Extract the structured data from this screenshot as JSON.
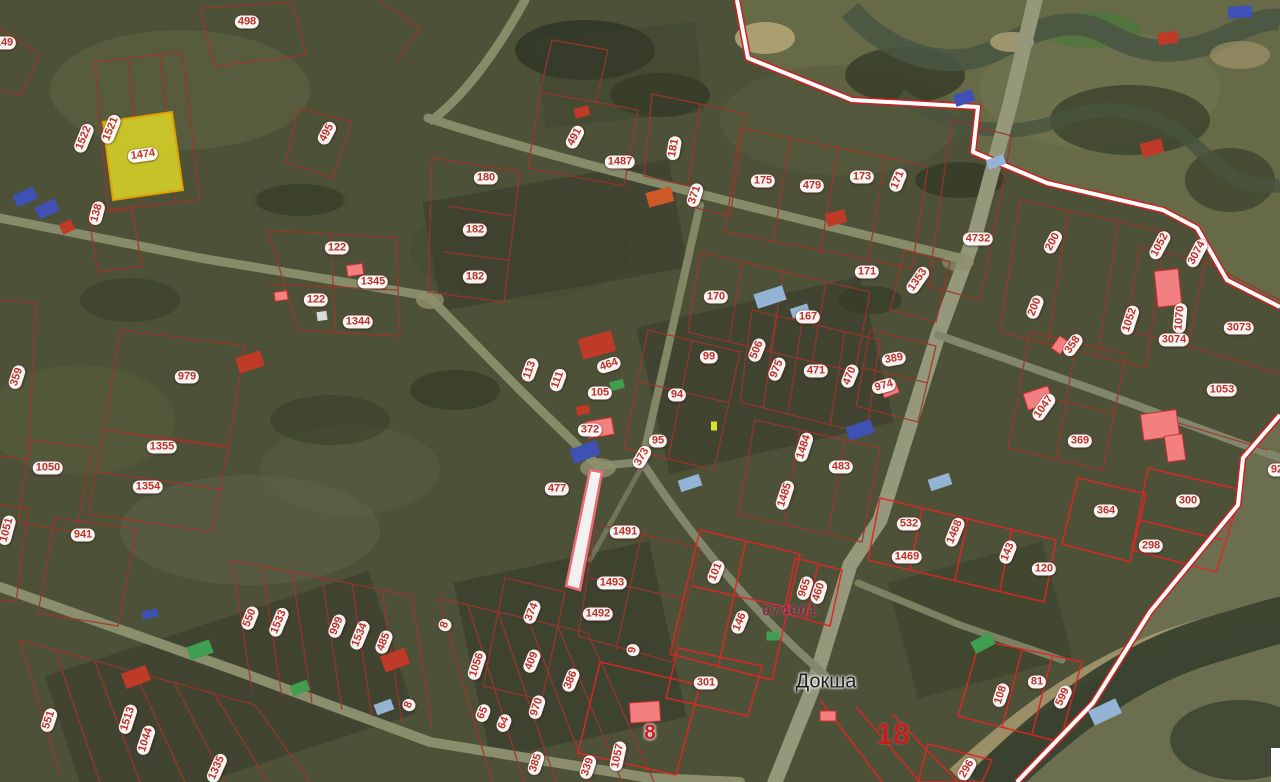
{
  "map": {
    "place_label": "Докша",
    "quarter_number": "074001",
    "district_number": "18",
    "red_parcel_number": "8",
    "selected_parcel_number": "1474",
    "colors": {
      "label_text": "#c03028",
      "label_bubble": "#ffffff",
      "parcel_line": "#9e352b",
      "parcel_line_selected_quarter": "#e02525",
      "settlement_boundary": "#cc2222",
      "selected_parcel_fill": "#d6d327",
      "selected_parcel_stroke": "#e0a000",
      "quarter_text": "#8d2440",
      "place_text": "#1d1d1d",
      "district_text": "#c41f1f",
      "building": {
        "red": "#c03a28",
        "orange": "#cc5a28",
        "pink": "#f28080",
        "blue": "#3f51b5",
        "lightblue": "#93b4d4",
        "green": "#3f9e4f",
        "white": "#dcdcdc",
        "yellow": "#d8e030"
      }
    },
    "parcel_labels": [
      {
        "t": "498",
        "x": 247,
        "y": 22,
        "r": 0
      },
      {
        "t": "149",
        "x": 4,
        "y": 43,
        "r": 0
      },
      {
        "t": "1522",
        "x": 84,
        "y": 138,
        "r": -68
      },
      {
        "t": "1521",
        "x": 111,
        "y": 129,
        "r": -68
      },
      {
        "t": "1474",
        "x": 143,
        "y": 155,
        "r": -8
      },
      {
        "t": "138",
        "x": 97,
        "y": 213,
        "r": -75
      },
      {
        "t": "495",
        "x": 327,
        "y": 133,
        "r": -62
      },
      {
        "t": "122",
        "x": 337,
        "y": 248,
        "r": 0
      },
      {
        "t": "122",
        "x": 316,
        "y": 300,
        "r": 0
      },
      {
        "t": "1345",
        "x": 373,
        "y": 282,
        "r": 0
      },
      {
        "t": "1344",
        "x": 358,
        "y": 322,
        "r": 0
      },
      {
        "t": "180",
        "x": 486,
        "y": 178,
        "r": 0
      },
      {
        "t": "182",
        "x": 475,
        "y": 230,
        "r": 0
      },
      {
        "t": "182",
        "x": 475,
        "y": 277,
        "r": 0
      },
      {
        "t": "491",
        "x": 575,
        "y": 137,
        "r": -62
      },
      {
        "t": "1487",
        "x": 620,
        "y": 162,
        "r": 0
      },
      {
        "t": "181",
        "x": 674,
        "y": 148,
        "r": -80
      },
      {
        "t": "371",
        "x": 695,
        "y": 195,
        "r": -72
      },
      {
        "t": "175",
        "x": 763,
        "y": 181,
        "r": 0
      },
      {
        "t": "479",
        "x": 812,
        "y": 186,
        "r": 0
      },
      {
        "t": "173",
        "x": 862,
        "y": 177,
        "r": 0
      },
      {
        "t": "171",
        "x": 898,
        "y": 180,
        "r": -68
      },
      {
        "t": "4732",
        "x": 978,
        "y": 239,
        "r": 0
      },
      {
        "t": "171",
        "x": 867,
        "y": 272,
        "r": 0
      },
      {
        "t": "1353",
        "x": 918,
        "y": 280,
        "r": -55
      },
      {
        "t": "170",
        "x": 716,
        "y": 297,
        "r": 0
      },
      {
        "t": "167",
        "x": 808,
        "y": 317,
        "r": 0
      },
      {
        "t": "200",
        "x": 1053,
        "y": 242,
        "r": -62
      },
      {
        "t": "1052",
        "x": 1160,
        "y": 245,
        "r": -62
      },
      {
        "t": "3074",
        "x": 1197,
        "y": 253,
        "r": -62
      },
      {
        "t": "200",
        "x": 1035,
        "y": 307,
        "r": -68
      },
      {
        "t": "1052",
        "x": 1130,
        "y": 320,
        "r": -72
      },
      {
        "t": "1070",
        "x": 1180,
        "y": 318,
        "r": -85
      },
      {
        "t": "358",
        "x": 1073,
        "y": 345,
        "r": -55
      },
      {
        "t": "3074",
        "x": 1174,
        "y": 340,
        "r": 0
      },
      {
        "t": "3073",
        "x": 1239,
        "y": 328,
        "r": 0
      },
      {
        "t": "1053",
        "x": 1222,
        "y": 390,
        "r": 0
      },
      {
        "t": "1047",
        "x": 1044,
        "y": 407,
        "r": -55
      },
      {
        "t": "369",
        "x": 1080,
        "y": 441,
        "r": 0
      },
      {
        "t": "113",
        "x": 530,
        "y": 370,
        "r": -70
      },
      {
        "t": "111",
        "x": 558,
        "y": 380,
        "r": -70
      },
      {
        "t": "464",
        "x": 609,
        "y": 365,
        "r": -18
      },
      {
        "t": "105",
        "x": 600,
        "y": 393,
        "r": 0
      },
      {
        "t": "99",
        "x": 709,
        "y": 357,
        "r": 0
      },
      {
        "t": "94",
        "x": 677,
        "y": 395,
        "r": 0
      },
      {
        "t": "372",
        "x": 590,
        "y": 430,
        "r": 0
      },
      {
        "t": "95",
        "x": 658,
        "y": 441,
        "r": 0
      },
      {
        "t": "373",
        "x": 642,
        "y": 457,
        "r": -60
      },
      {
        "t": "506",
        "x": 757,
        "y": 350,
        "r": -68
      },
      {
        "t": "975",
        "x": 777,
        "y": 369,
        "r": -68
      },
      {
        "t": "471",
        "x": 816,
        "y": 371,
        "r": 0
      },
      {
        "t": "470",
        "x": 850,
        "y": 376,
        "r": -68
      },
      {
        "t": "1484",
        "x": 804,
        "y": 447,
        "r": -72
      },
      {
        "t": "483",
        "x": 841,
        "y": 467,
        "r": 0
      },
      {
        "t": "1485",
        "x": 785,
        "y": 495,
        "r": -72
      },
      {
        "t": "389",
        "x": 894,
        "y": 359,
        "r": -10
      },
      {
        "t": "974",
        "x": 884,
        "y": 386,
        "r": -15
      },
      {
        "t": "359",
        "x": 17,
        "y": 377,
        "r": -72
      },
      {
        "t": "979",
        "x": 187,
        "y": 377,
        "r": 0
      },
      {
        "t": "1355",
        "x": 162,
        "y": 447,
        "r": 0
      },
      {
        "t": "1050",
        "x": 48,
        "y": 468,
        "r": 0
      },
      {
        "t": "1354",
        "x": 148,
        "y": 487,
        "r": 0
      },
      {
        "t": "477",
        "x": 557,
        "y": 489,
        "r": 0
      },
      {
        "t": "941",
        "x": 83,
        "y": 535,
        "r": 0
      },
      {
        "t": "1051",
        "x": 7,
        "y": 530,
        "r": -75
      },
      {
        "t": "1491",
        "x": 625,
        "y": 532,
        "r": 0
      },
      {
        "t": "1493",
        "x": 612,
        "y": 583,
        "r": 0
      },
      {
        "t": "1492",
        "x": 598,
        "y": 614,
        "r": 0
      },
      {
        "t": "374",
        "x": 532,
        "y": 612,
        "r": -68
      },
      {
        "t": "9",
        "x": 633,
        "y": 650,
        "r": -80
      },
      {
        "t": "8",
        "x": 445,
        "y": 625,
        "r": -70
      },
      {
        "t": "1056",
        "x": 477,
        "y": 665,
        "r": -72
      },
      {
        "t": "409",
        "x": 532,
        "y": 661,
        "r": -68
      },
      {
        "t": "386",
        "x": 571,
        "y": 680,
        "r": -68
      },
      {
        "t": "970",
        "x": 537,
        "y": 707,
        "r": -72
      },
      {
        "t": "65",
        "x": 483,
        "y": 713,
        "r": -68
      },
      {
        "t": "64",
        "x": 504,
        "y": 723,
        "r": -68
      },
      {
        "t": "8",
        "x": 409,
        "y": 705,
        "r": -70
      },
      {
        "t": "550",
        "x": 250,
        "y": 618,
        "r": -68
      },
      {
        "t": "1533",
        "x": 279,
        "y": 622,
        "r": -68
      },
      {
        "t": "999",
        "x": 337,
        "y": 626,
        "r": -68
      },
      {
        "t": "1534",
        "x": 360,
        "y": 635,
        "r": -68
      },
      {
        "t": "485",
        "x": 384,
        "y": 642,
        "r": -68
      },
      {
        "t": "551",
        "x": 49,
        "y": 720,
        "r": -72
      },
      {
        "t": "1513",
        "x": 128,
        "y": 719,
        "r": -72
      },
      {
        "t": "1044",
        "x": 146,
        "y": 740,
        "r": -72
      },
      {
        "t": "1335",
        "x": 217,
        "y": 768,
        "r": -66
      },
      {
        "t": "385",
        "x": 536,
        "y": 763,
        "r": -72
      },
      {
        "t": "339",
        "x": 588,
        "y": 767,
        "r": -72
      },
      {
        "t": "1057",
        "x": 618,
        "y": 756,
        "r": -78
      },
      {
        "t": "101",
        "x": 716,
        "y": 572,
        "r": -68
      },
      {
        "t": "146",
        "x": 740,
        "y": 622,
        "r": -68
      },
      {
        "t": "965",
        "x": 805,
        "y": 588,
        "r": -72
      },
      {
        "t": "460",
        "x": 819,
        "y": 592,
        "r": -72
      },
      {
        "t": "301",
        "x": 706,
        "y": 683,
        "r": 0
      },
      {
        "t": "532",
        "x": 909,
        "y": 524,
        "r": 0
      },
      {
        "t": "1468",
        "x": 955,
        "y": 532,
        "r": -68
      },
      {
        "t": "1469",
        "x": 907,
        "y": 557,
        "r": 0
      },
      {
        "t": "143",
        "x": 1008,
        "y": 552,
        "r": -68
      },
      {
        "t": "120",
        "x": 1044,
        "y": 569,
        "r": 0
      },
      {
        "t": "364",
        "x": 1106,
        "y": 511,
        "r": 0
      },
      {
        "t": "300",
        "x": 1188,
        "y": 501,
        "r": 0
      },
      {
        "t": "298",
        "x": 1151,
        "y": 546,
        "r": 0
      },
      {
        "t": "81",
        "x": 1037,
        "y": 682,
        "r": 0
      },
      {
        "t": "108",
        "x": 1001,
        "y": 695,
        "r": -72
      },
      {
        "t": "599",
        "x": 1063,
        "y": 697,
        "r": -65
      },
      {
        "t": "296",
        "x": 967,
        "y": 769,
        "r": -60
      },
      {
        "t": "92",
        "x": 1277,
        "y": 470,
        "r": 0
      }
    ],
    "buildings": [
      {
        "x": 25,
        "y": 197,
        "w": 22,
        "h": 13,
        "r": -25,
        "c": "blue"
      },
      {
        "x": 47,
        "y": 209,
        "w": 22,
        "h": 13,
        "r": -25,
        "c": "blue"
      },
      {
        "x": 67,
        "y": 227,
        "w": 13,
        "h": 11,
        "r": -25,
        "c": "red"
      },
      {
        "x": 582,
        "y": 112,
        "w": 15,
        "h": 10,
        "r": -15,
        "c": "red"
      },
      {
        "x": 660,
        "y": 197,
        "w": 26,
        "h": 15,
        "r": -15,
        "c": "orange"
      },
      {
        "x": 836,
        "y": 218,
        "w": 20,
        "h": 13,
        "r": -15,
        "c": "red"
      },
      {
        "x": 355,
        "y": 270,
        "w": 16,
        "h": 11,
        "r": -8,
        "c": "pink"
      },
      {
        "x": 281,
        "y": 296,
        "w": 13,
        "h": 9,
        "r": -8,
        "c": "pink"
      },
      {
        "x": 322,
        "y": 316,
        "w": 10,
        "h": 9,
        "r": -8,
        "c": "white"
      },
      {
        "x": 250,
        "y": 362,
        "w": 26,
        "h": 16,
        "r": -18,
        "c": "red"
      },
      {
        "x": 597,
        "y": 345,
        "w": 34,
        "h": 21,
        "r": -15,
        "c": "red"
      },
      {
        "x": 583,
        "y": 410,
        "w": 13,
        "h": 9,
        "r": -12,
        "c": "red"
      },
      {
        "x": 600,
        "y": 428,
        "w": 26,
        "h": 17,
        "r": -10,
        "c": "pink"
      },
      {
        "x": 585,
        "y": 452,
        "w": 28,
        "h": 15,
        "r": -20,
        "c": "blue"
      },
      {
        "x": 770,
        "y": 297,
        "w": 30,
        "h": 15,
        "r": -18,
        "c": "lightblue"
      },
      {
        "x": 800,
        "y": 311,
        "w": 18,
        "h": 10,
        "r": -18,
        "c": "lightblue"
      },
      {
        "x": 1152,
        "y": 148,
        "w": 22,
        "h": 14,
        "r": -15,
        "c": "red"
      },
      {
        "x": 1168,
        "y": 38,
        "w": 20,
        "h": 12,
        "r": -8,
        "c": "red"
      },
      {
        "x": 1240,
        "y": 12,
        "w": 24,
        "h": 12,
        "r": -4,
        "c": "blue"
      },
      {
        "x": 964,
        "y": 98,
        "w": 20,
        "h": 12,
        "r": -20,
        "c": "blue"
      },
      {
        "x": 996,
        "y": 162,
        "w": 18,
        "h": 10,
        "r": -20,
        "c": "lightblue"
      },
      {
        "x": 1060,
        "y": 345,
        "w": 15,
        "h": 11,
        "r": -55,
        "c": "pink"
      },
      {
        "x": 1168,
        "y": 288,
        "w": 24,
        "h": 36,
        "r": -6,
        "c": "pink"
      },
      {
        "x": 1160,
        "y": 425,
        "w": 36,
        "h": 26,
        "r": -8,
        "c": "pink"
      },
      {
        "x": 1175,
        "y": 448,
        "w": 18,
        "h": 26,
        "r": -8,
        "c": "pink"
      },
      {
        "x": 1038,
        "y": 398,
        "w": 26,
        "h": 17,
        "r": -18,
        "c": "pink"
      },
      {
        "x": 890,
        "y": 390,
        "w": 16,
        "h": 11,
        "r": -20,
        "c": "pink"
      },
      {
        "x": 860,
        "y": 430,
        "w": 26,
        "h": 14,
        "r": -18,
        "c": "blue"
      },
      {
        "x": 940,
        "y": 482,
        "w": 22,
        "h": 12,
        "r": -18,
        "c": "lightblue"
      },
      {
        "x": 983,
        "y": 643,
        "w": 22,
        "h": 13,
        "r": -28,
        "c": "green"
      },
      {
        "x": 200,
        "y": 650,
        "w": 24,
        "h": 14,
        "r": -20,
        "c": "green"
      },
      {
        "x": 300,
        "y": 688,
        "w": 18,
        "h": 11,
        "r": -20,
        "c": "green"
      },
      {
        "x": 136,
        "y": 677,
        "w": 26,
        "h": 16,
        "r": -20,
        "c": "red"
      },
      {
        "x": 395,
        "y": 660,
        "w": 26,
        "h": 17,
        "r": -20,
        "c": "red"
      },
      {
        "x": 384,
        "y": 707,
        "w": 18,
        "h": 11,
        "r": -20,
        "c": "lightblue"
      },
      {
        "x": 1105,
        "y": 712,
        "w": 30,
        "h": 16,
        "r": -25,
        "c": "lightblue"
      },
      {
        "x": 828,
        "y": 716,
        "w": 16,
        "h": 10,
        "r": 0,
        "c": "pink"
      },
      {
        "x": 773,
        "y": 636,
        "w": 13,
        "h": 9,
        "r": 0,
        "c": "green"
      },
      {
        "x": 645,
        "y": 712,
        "w": 30,
        "h": 20,
        "r": -4,
        "c": "pink"
      },
      {
        "x": 690,
        "y": 483,
        "w": 22,
        "h": 12,
        "r": -18,
        "c": "lightblue"
      },
      {
        "x": 714,
        "y": 426,
        "w": 6,
        "h": 9,
        "r": 0,
        "c": "yellow"
      },
      {
        "x": 150,
        "y": 614,
        "w": 16,
        "h": 8,
        "r": -10,
        "c": "blue"
      },
      {
        "x": 617,
        "y": 385,
        "w": 14,
        "h": 9,
        "r": -15,
        "c": "green"
      }
    ]
  }
}
